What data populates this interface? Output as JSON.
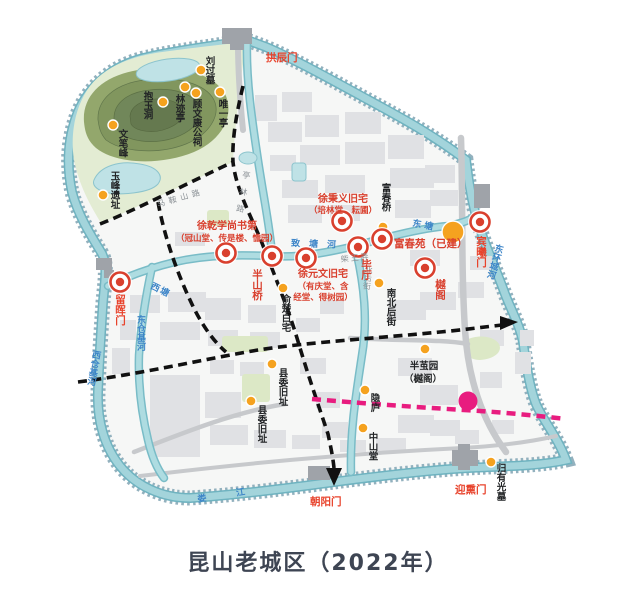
{
  "title": "昆山老城区（2022年）",
  "legend_colors": {
    "heritage_marker_red": "#d9402e",
    "site_dot_orange": "#f5a21f",
    "planned_route_pink": "#e81c7f",
    "water": "#a3d4db",
    "water_label_blue": "#3d85c8",
    "street_label_gray": "#8b9196",
    "route_dash_black": "#111111",
    "hill_green": "#81965e",
    "title_color": "#3e4553"
  },
  "gates": [
    {
      "label": "拱辰门"
    },
    {
      "label": "留晖门"
    },
    {
      "label": "宾曦门"
    },
    {
      "label": "朝阳门"
    },
    {
      "label": "迎熏门"
    }
  ],
  "major_sites": [
    {
      "line1": "徐乾学尚书第",
      "line2": "（冠山堂、传是楼、憺园）"
    },
    {
      "label": "半山桥"
    },
    {
      "line1": "徐元文旧宅",
      "line2": "（有庆堂、含",
      "line3": "经堂、得树园）"
    },
    {
      "line1": "徐秉义旧宅",
      "line2": "（培林堂、耘圃）"
    },
    {
      "label": "毕厅"
    },
    {
      "label": "富春苑（已建）"
    },
    {
      "label": "樾阁"
    }
  ],
  "minor_sites": [
    {
      "label": "刘过墓"
    },
    {
      "label": "唯一亭"
    },
    {
      "label": "顾文康公祠"
    },
    {
      "label": "林迹亭"
    },
    {
      "label": "抱玉洞"
    },
    {
      "label": "文笔峰"
    },
    {
      "label": "玉峰遗址"
    },
    {
      "label": "富春桥"
    },
    {
      "label": "俞楚白宅"
    },
    {
      "label": "南北后街"
    },
    {
      "line1": "半茧园",
      "line2": "（樾阁）"
    },
    {
      "label": "隐庐"
    },
    {
      "label": "中山堂"
    },
    {
      "label": "县委旧址"
    },
    {
      "label": "县委旧址"
    },
    {
      "label": "归有光墓"
    }
  ],
  "waterways": [
    {
      "label": "西塘"
    },
    {
      "label": "东塘"
    },
    {
      "label": "致塘河"
    },
    {
      "label": "东仓基河"
    },
    {
      "label": "西仓基河"
    },
    {
      "label": "东环城河"
    },
    {
      "label": "娄江"
    }
  ],
  "streets": [
    {
      "label": "马鞍山路"
    },
    {
      "label": "亭林路"
    },
    {
      "label": "北后街"
    },
    {
      "label": "柴王弄"
    }
  ]
}
